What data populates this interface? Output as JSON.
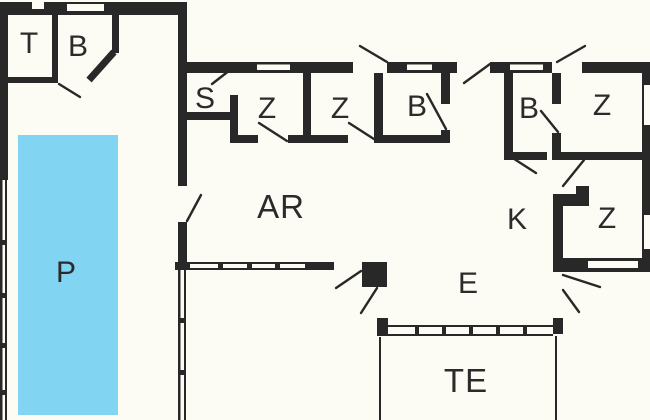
{
  "title": "floor-plan",
  "colors": {
    "background": "#fcfcf5",
    "wall": "#282828",
    "label": "#2b2b2b",
    "pool": "#82d5f2"
  },
  "rooms": [
    {
      "id": "toilet",
      "label": "T"
    },
    {
      "id": "bath-entry",
      "label": "B"
    },
    {
      "id": "sauna",
      "label": "S"
    },
    {
      "id": "bedroom-1",
      "label": "Z"
    },
    {
      "id": "bedroom-2",
      "label": "Z"
    },
    {
      "id": "bathroom-1",
      "label": "B"
    },
    {
      "id": "bathroom-2",
      "label": "B"
    },
    {
      "id": "bedroom-3",
      "label": "Z"
    },
    {
      "id": "living-area",
      "label": "AR"
    },
    {
      "id": "kitchen",
      "label": "K"
    },
    {
      "id": "bedroom-4",
      "label": "Z"
    },
    {
      "id": "dining-area",
      "label": "E"
    },
    {
      "id": "pool",
      "label": "P"
    },
    {
      "id": "terrace",
      "label": "TE"
    }
  ]
}
